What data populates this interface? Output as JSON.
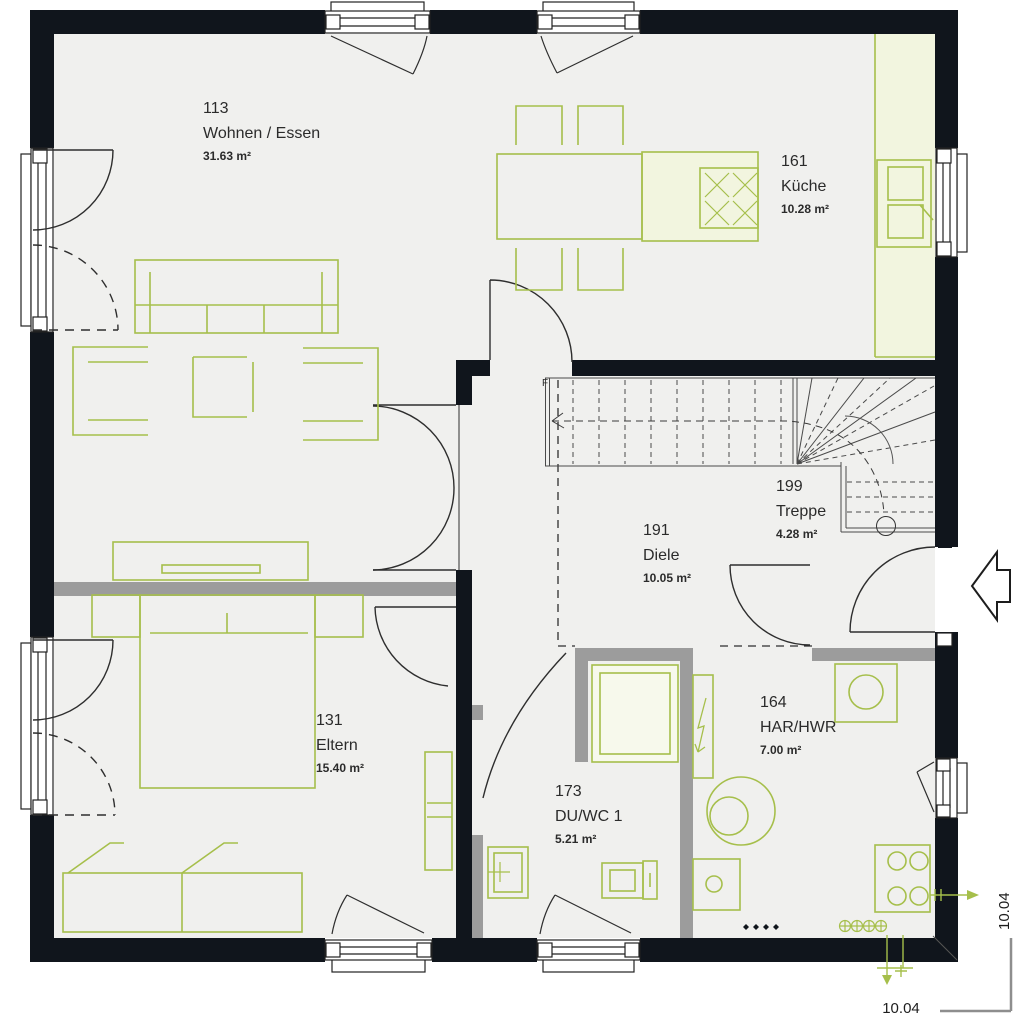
{
  "plan_title": "Erdgeschoss Grundriss",
  "rooms": [
    {
      "number": "113",
      "name": "Wohnen / Essen",
      "area": "31.63 m²"
    },
    {
      "number": "161",
      "name": "Küche",
      "area": "10.28 m²"
    },
    {
      "number": "199",
      "name": "Treppe",
      "area": "4.28 m²"
    },
    {
      "number": "191",
      "name": "Diele",
      "area": "10.05 m²"
    },
    {
      "number": "131",
      "name": "Eltern",
      "area": "15.40 m²"
    },
    {
      "number": "173",
      "name": "DU/WC 1",
      "area": "5.21 m²"
    },
    {
      "number": "164",
      "name": "HAR/HWR",
      "area": "7.00 m²"
    }
  ],
  "dimensions": {
    "bottom": "10.04",
    "right": "10.04"
  },
  "stair_note": "F",
  "colors": {
    "wall_black": "#10151c",
    "gray_wall": "#9c9c9c",
    "furniture_green": "#a6bf4b",
    "counter_fill": "#f2f5df",
    "room_fill": "#f0f0ee",
    "door_arc": "#2e2e2e",
    "dimension_gray": "#8e8e8e"
  }
}
